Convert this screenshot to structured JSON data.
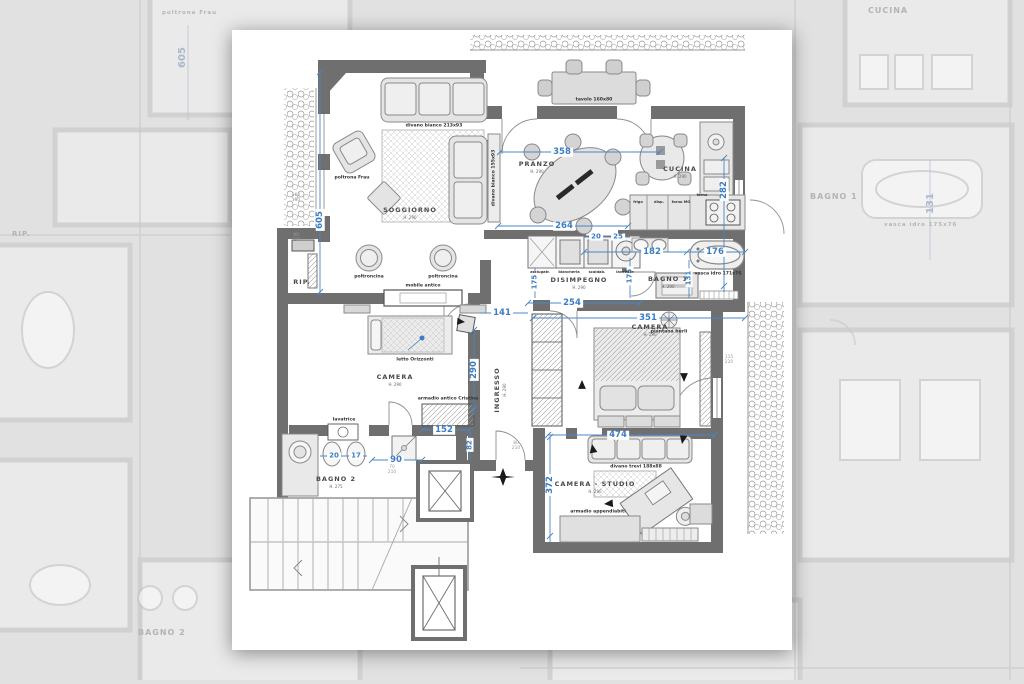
{
  "colors": {
    "dimension_blue": "#3b7dc4",
    "wall_gray": "#6f6f6f",
    "paper_white": "#ffffff",
    "backdrop_gray": "#e1e1e1",
    "furniture_line": "#8a8a8a"
  },
  "rooms": [
    {
      "name": "SOGGIORNO",
      "h": "H. 290"
    },
    {
      "name": "PRANZO",
      "h": "H. 290"
    },
    {
      "name": "CUCINA",
      "h": "H. 290"
    },
    {
      "name": "DISIMPEGNO",
      "h": "H. 290"
    },
    {
      "name": "BAGNO 1",
      "h": "H. 290"
    },
    {
      "name": "CAMERA",
      "h": "H. 290"
    },
    {
      "name": "INGRESSO",
      "h": "H. 290"
    },
    {
      "name": "CAMERA",
      "h": "H. 290"
    },
    {
      "name": "BAGNO 2",
      "h": "H. 275"
    },
    {
      "name": "CAMERA - STUDIO",
      "h": "H. 290"
    },
    {
      "name": "RIP."
    }
  ],
  "dims": [
    {
      "v": "605"
    },
    {
      "v": "358"
    },
    {
      "v": "282"
    },
    {
      "v": "264"
    },
    {
      "v": "20"
    },
    {
      "v": "25"
    },
    {
      "v": "182"
    },
    {
      "v": "176"
    },
    {
      "v": "175"
    },
    {
      "v": "175"
    },
    {
      "v": "131"
    },
    {
      "v": "254"
    },
    {
      "v": "351"
    },
    {
      "v": "141"
    },
    {
      "v": "290"
    },
    {
      "v": "152"
    },
    {
      "v": "82"
    },
    {
      "v": "90"
    },
    {
      "v": "20"
    },
    {
      "v": "17"
    },
    {
      "v": "474"
    },
    {
      "v": "372"
    }
  ],
  "furniture": [
    "divano bianco 213x93",
    "divano bianco 155x93",
    "poltrona Frau",
    "poltroncina",
    "poltroncina",
    "mobile antico",
    "tavolo 160x80",
    "letto Orizzonti",
    "armadio antico Cristina",
    "piantana burli",
    "vasca idro 171x76",
    "divano trevi 188x88",
    "armadio appendiabiti",
    "lavatrice"
  ],
  "kitchen": [
    "frigo",
    "disp.",
    "forno MO",
    "forno"
  ],
  "laundry": [
    "asciugatr.",
    "biancheria",
    "scaldab.",
    "lavatrice"
  ],
  "notes": [
    "160\n150",
    "90\n230",
    "80\n210",
    "70\n210",
    "115\n220"
  ],
  "bg": [
    "CUCINA",
    "BAGNO 1",
    "BAGNO 2",
    "RIP.",
    "poltrona Frau",
    "vasca idro 175x76",
    "605",
    "131",
    "282"
  ]
}
